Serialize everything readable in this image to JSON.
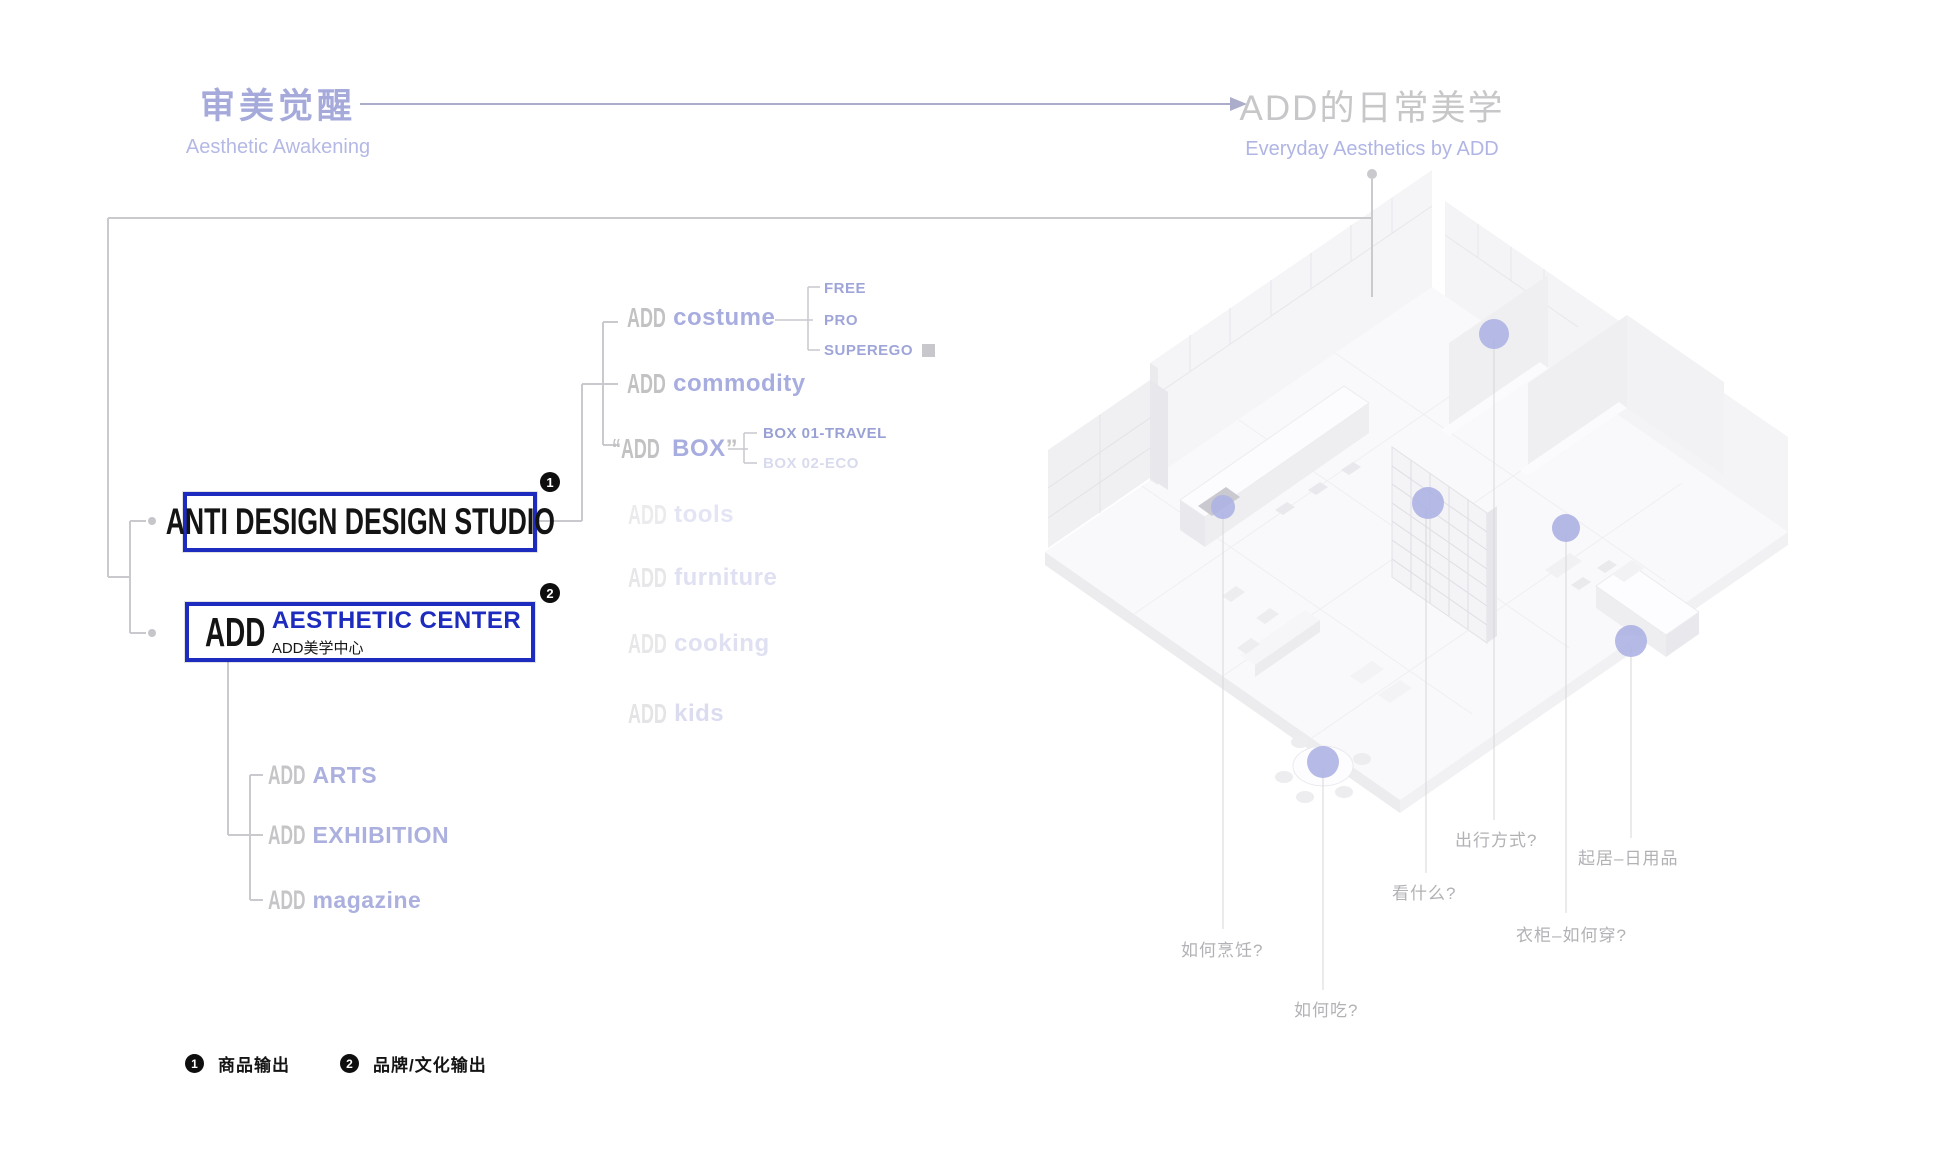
{
  "colors": {
    "accent_blue": "#1d2cbe",
    "lavender": "#a8ade0",
    "gray_label": "#c2c2c5",
    "hotspot_purple": "#adb2e3",
    "black": "#141414"
  },
  "header": {
    "left_title_zh": "审美觉醒",
    "left_title_en": "Aesthetic Awakening",
    "right_title_zh": "ADD的日常美学",
    "right_title_en": "Everyday Aesthetics by ADD"
  },
  "boxes": {
    "studio": {
      "label": "ANTI DESIGN DESIGN STUDIO",
      "badge": "1"
    },
    "center": {
      "prefix": "ADD",
      "title": "AESTHETIC CENTER",
      "subtitle": "ADD美学中心",
      "badge": "2"
    }
  },
  "products": {
    "costume": {
      "prefix": "ADD",
      "label": "costume",
      "children": {
        "free": "FREE",
        "pro": "PRO",
        "superego": "SUPEREGO"
      }
    },
    "commodity": {
      "prefix": "ADD",
      "label": "commodity"
    },
    "box": {
      "prefix": "“ADD",
      "label": "BOX",
      "suffix": "”",
      "children": {
        "b1": "BOX 01-TRAVEL",
        "b2": "BOX 02-ECO"
      }
    },
    "tools": {
      "prefix": "ADD",
      "label": "tools"
    },
    "furniture": {
      "prefix": "ADD",
      "label": "furniture"
    },
    "cooking": {
      "prefix": "ADD",
      "label": "cooking"
    },
    "kids": {
      "prefix": "ADD",
      "label": "kids"
    }
  },
  "culture": {
    "arts": {
      "prefix": "ADD",
      "label": "ARTS"
    },
    "exhibition": {
      "prefix": "ADD",
      "label": "EXHIBITION"
    },
    "magazine": {
      "prefix": "ADD",
      "label": "magazine"
    }
  },
  "legend": {
    "item1": {
      "badge": "1",
      "label": "商品输出"
    },
    "item2": {
      "badge": "2",
      "label": "品牌/文化输出"
    }
  },
  "floorplan": {
    "labels": {
      "cooking": "如何烹饪?",
      "eating": "如何吃?",
      "watching": "看什么?",
      "travel": "出行方式?",
      "wardrobe": "衣柜–如何穿?",
      "living": "起居–日用品"
    }
  }
}
